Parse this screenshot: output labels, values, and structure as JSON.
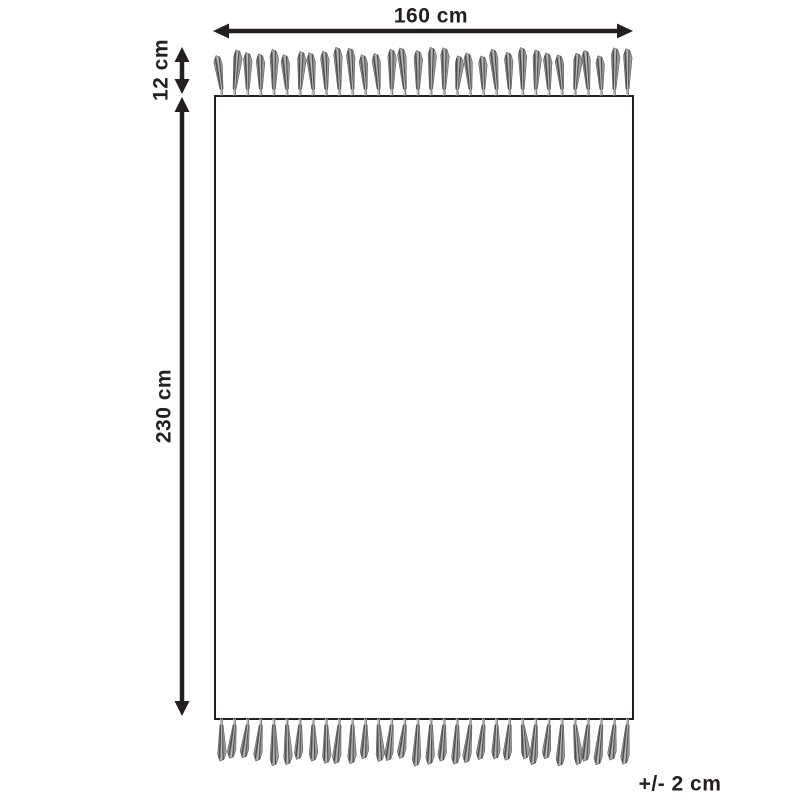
{
  "diagram": {
    "labels": {
      "width": "160 cm",
      "fringe_length": "12 cm",
      "height": "230 cm",
      "tolerance": "+/- 2 cm"
    },
    "colors": {
      "line": "#231f20",
      "text": "#231f20",
      "background": "#ffffff",
      "tassel_dark": "#4d4d4d",
      "tassel_mid": "#828282",
      "tassel_light": "#bdbdbd"
    },
    "fringe": {
      "top_tassel_count": 32,
      "bottom_tassel_count": 32
    }
  }
}
